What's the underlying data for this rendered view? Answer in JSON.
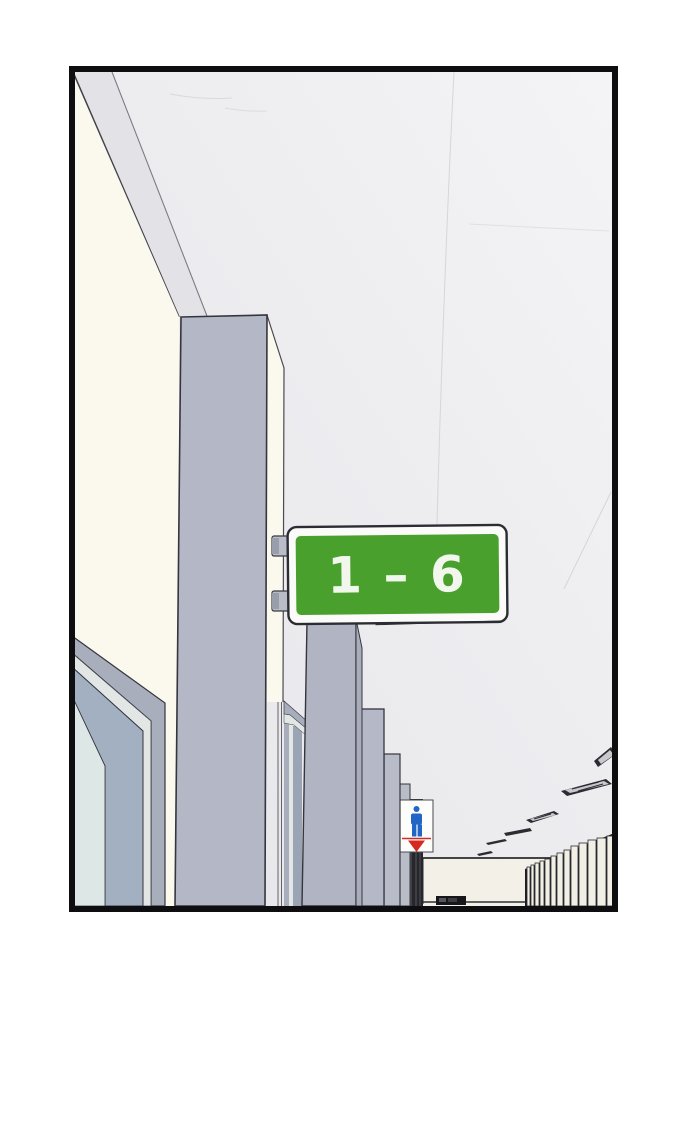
{
  "scene": {
    "range_sign": {
      "text": "1 – 6"
    },
    "restroom_sign": {
      "male_icon": "male-pictogram",
      "female_icon": "female-pictogram"
    },
    "colors": {
      "range_sign_green": "#4aa02d",
      "range_sign_text": "#f2f7ed",
      "range_sign_frame": "#fbfcf9",
      "restroom_male_blue": "#2166c4",
      "restroom_female_red": "#d7281f",
      "wall_cream": "#fbf8ee",
      "pillar_gray": "#b4b8c6",
      "ceiling_gray": "#ebebee",
      "panel_border_black": "#0e0e10"
    }
  }
}
